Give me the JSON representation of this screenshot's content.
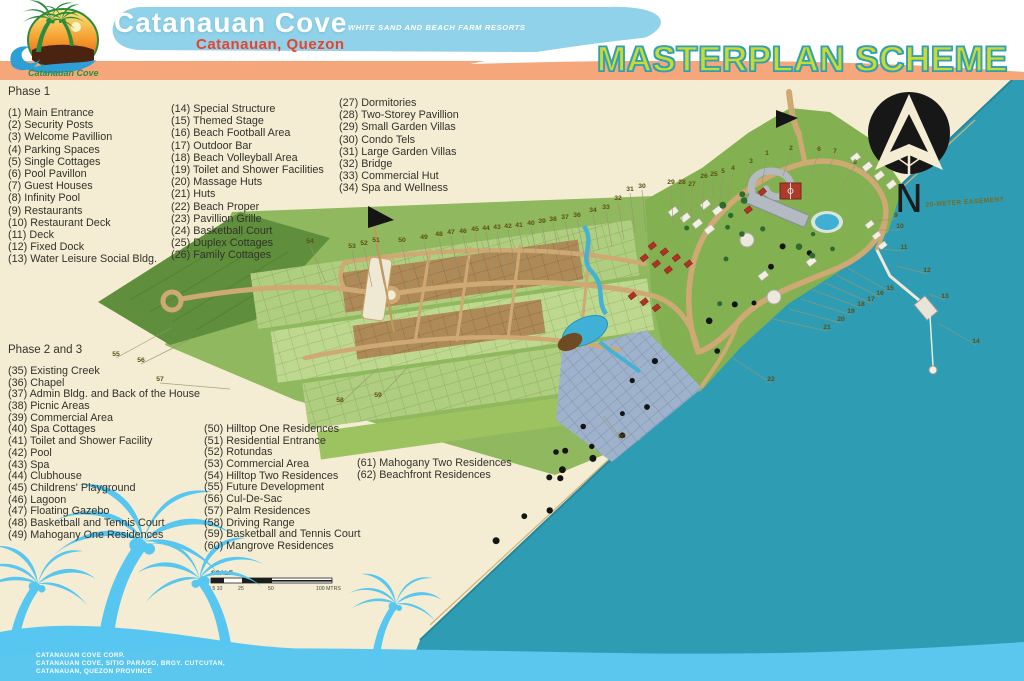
{
  "header": {
    "resort_name": "Catanauan Cove",
    "tagline": "WHITE SAND AND BEACH FARM RESORTS",
    "location": "Catanauan, Quezon",
    "plan_title": "MASTERPLAN SCHEME",
    "logo_script": "Catanauan Cove"
  },
  "legend": {
    "phase1": {
      "title": "Phase 1",
      "columns": [
        [
          "(1) Main Entrance",
          "(2) Security Posts",
          "(3) Welcome Pavillion",
          "(4) Parking Spaces",
          "(5) Single Cottages",
          "(6) Pool Pavillon",
          "(7) Guest Houses",
          "(8) Infinity Pool",
          "(9) Restaurants",
          "(10) Restaurant Deck",
          "(11) Deck",
          "(12) Fixed Dock",
          "(13) Water Leisure Social Bldg."
        ],
        [
          "(14) Special Structure",
          "(15) Themed Stage",
          "(16) Beach Football Area",
          "(17) Outdoor Bar",
          "(18) Beach Volleyball Area",
          "(19) Toilet and Shower Facilities",
          "(20) Massage Huts",
          "(21) Huts",
          "(22) Beach Proper",
          "(23) Pavillion Grille",
          "(24) Basketball Court",
          "(25) Duplex Cottages",
          "(26) Family Cottages"
        ],
        [
          "(27) Dormitories",
          "(28) Two-Storey Pavillion",
          "(29) Small Garden Villas",
          "(30) Condo Tels",
          "(31) Large Garden Villas",
          "(32) Bridge",
          "(33) Commercial Hut",
          "(34) Spa and Wellness"
        ]
      ]
    },
    "phase2": {
      "title": "Phase 2 and 3",
      "columns": [
        [
          "(35) Existing Creek",
          "(36) Chapel",
          "(37) Admin Bldg. and Back of the House",
          "(38) Picnic Areas",
          "(39) Commercial Area",
          "(40) Spa Cottages",
          "(41) Toilet and Shower Facility",
          "(42) Pool",
          "(43) Spa",
          "(44) Clubhouse",
          "(45) Childrens' Playground",
          "(46) Lagoon",
          "(47) Floating Gazebo",
          "(48) Basketball and Tennis Court",
          "(49) Mahogany One Residences"
        ],
        [
          "(50) Hilltop One Residences",
          "(51) Residential Entrance",
          "(52) Rotundas",
          "(53) Commercial Area",
          "(54) Hilltop Two Residences",
          "(55) Future Development",
          "(56) Cul-De-Sac",
          "(57) Palm Residences",
          "(58) Driving Range",
          "(59) Basketball and Tennis Court",
          "(60) Mangrove Residences"
        ],
        [
          "(61) Mahogany Two Residences",
          "(62) Beachfront Residences"
        ]
      ]
    }
  },
  "map": {
    "north_label": "N",
    "easement_label": "20-METER EASEMENT",
    "scale": {
      "label": "SCALE",
      "ticks": [
        "0 5 10",
        "25",
        "50",
        "100 MTRS"
      ]
    },
    "markers": [
      {
        "n": "53",
        "x": 352,
        "y": 248,
        "dx": 8,
        "dy": 42
      },
      {
        "n": "52",
        "x": 364,
        "y": 245,
        "dx": 8,
        "dy": 42
      },
      {
        "n": "51",
        "x": 376,
        "y": 242,
        "dx": 8,
        "dy": 42
      },
      {
        "n": "50",
        "x": 402,
        "y": 242,
        "dx": 8,
        "dy": 42
      },
      {
        "n": "49",
        "x": 424,
        "y": 239,
        "dx": 8,
        "dy": 42
      },
      {
        "n": "48",
        "x": 439,
        "y": 236,
        "dx": 8,
        "dy": 42
      },
      {
        "n": "47",
        "x": 451,
        "y": 234,
        "dx": 8,
        "dy": 42
      },
      {
        "n": "46",
        "x": 463,
        "y": 233,
        "dx": 8,
        "dy": 42
      },
      {
        "n": "45",
        "x": 475,
        "y": 231,
        "dx": 8,
        "dy": 42
      },
      {
        "n": "44",
        "x": 486,
        "y": 230,
        "dx": 8,
        "dy": 42
      },
      {
        "n": "43",
        "x": 497,
        "y": 229,
        "dx": 8,
        "dy": 42
      },
      {
        "n": "42",
        "x": 508,
        "y": 228,
        "dx": 8,
        "dy": 42
      },
      {
        "n": "41",
        "x": 519,
        "y": 227,
        "dx": 8,
        "dy": 42
      },
      {
        "n": "40",
        "x": 531,
        "y": 225,
        "dx": 8,
        "dy": 42
      },
      {
        "n": "39",
        "x": 542,
        "y": 223,
        "dx": 8,
        "dy": 42
      },
      {
        "n": "38",
        "x": 553,
        "y": 221,
        "dx": 8,
        "dy": 42
      },
      {
        "n": "37",
        "x": 565,
        "y": 219,
        "dx": 8,
        "dy": 42
      },
      {
        "n": "36",
        "x": 577,
        "y": 217,
        "dx": 8,
        "dy": 42
      },
      {
        "n": "34",
        "x": 593,
        "y": 212,
        "dx": 6,
        "dy": 38
      },
      {
        "n": "33",
        "x": 606,
        "y": 209,
        "dx": 6,
        "dy": 38
      },
      {
        "n": "32",
        "x": 618,
        "y": 200,
        "dx": 6,
        "dy": 40
      },
      {
        "n": "31",
        "x": 630,
        "y": 191,
        "dx": 5,
        "dy": 42
      },
      {
        "n": "30",
        "x": 642,
        "y": 188,
        "dx": 4,
        "dy": 44
      },
      {
        "n": "29",
        "x": 671,
        "y": 184,
        "dx": 2,
        "dy": 40
      },
      {
        "n": "28",
        "x": 682,
        "y": 184,
        "dx": 0,
        "dy": 38
      },
      {
        "n": "27",
        "x": 692,
        "y": 186,
        "dx": 0,
        "dy": 36
      },
      {
        "n": "26",
        "x": 704,
        "y": 178,
        "dx": -2,
        "dy": 36
      },
      {
        "n": "25",
        "x": 714,
        "y": 176,
        "dx": -3,
        "dy": 34
      },
      {
        "n": "5",
        "x": 723,
        "y": 173,
        "dx": -4,
        "dy": 32
      },
      {
        "n": "4",
        "x": 733,
        "y": 170,
        "dx": -5,
        "dy": 30
      },
      {
        "n": "3",
        "x": 751,
        "y": 163,
        "dx": -6,
        "dy": 28
      },
      {
        "n": "1",
        "x": 767,
        "y": 155,
        "dx": -5,
        "dy": 28
      },
      {
        "n": "2",
        "x": 791,
        "y": 150,
        "dx": -8,
        "dy": 26
      },
      {
        "n": "6",
        "x": 819,
        "y": 151,
        "dx": -10,
        "dy": 26
      },
      {
        "n": "7",
        "x": 835,
        "y": 153,
        "dx": -12,
        "dy": 26
      },
      {
        "n": "8",
        "x": 855,
        "y": 164,
        "dx": -14,
        "dy": 24
      },
      {
        "n": "55",
        "x": 116,
        "y": 356,
        "dx": 55,
        "dy": -28
      },
      {
        "n": "56",
        "x": 141,
        "y": 362,
        "dx": 48,
        "dy": -22
      },
      {
        "n": "57",
        "x": 160,
        "y": 381,
        "dx": 70,
        "dy": 8
      },
      {
        "n": "54",
        "x": 310,
        "y": 243,
        "dx": 16,
        "dy": 40
      },
      {
        "n": "58",
        "x": 340,
        "y": 402,
        "dx": 38,
        "dy": -34
      },
      {
        "n": "59",
        "x": 378,
        "y": 397,
        "dx": 30,
        "dy": -30
      },
      {
        "n": "9",
        "x": 896,
        "y": 217,
        "dx": -22,
        "dy": 4
      },
      {
        "n": "10",
        "x": 900,
        "y": 228,
        "dx": -24,
        "dy": 2
      },
      {
        "n": "11",
        "x": 904,
        "y": 249,
        "dx": -26,
        "dy": 0
      },
      {
        "n": "12",
        "x": 927,
        "y": 272,
        "dx": -30,
        "dy": -6
      },
      {
        "n": "13",
        "x": 945,
        "y": 298,
        "dx": -16,
        "dy": -4
      },
      {
        "n": "14",
        "x": 976,
        "y": 343,
        "dx": -38,
        "dy": -20
      },
      {
        "n": "15",
        "x": 890,
        "y": 290,
        "dx": -42,
        "dy": -22
      },
      {
        "n": "16",
        "x": 880,
        "y": 295,
        "dx": -44,
        "dy": -20
      },
      {
        "n": "17",
        "x": 871,
        "y": 301,
        "dx": -46,
        "dy": -18
      },
      {
        "n": "18",
        "x": 861,
        "y": 306,
        "dx": -48,
        "dy": -16
      },
      {
        "n": "19",
        "x": 851,
        "y": 313,
        "dx": -50,
        "dy": -14
      },
      {
        "n": "20",
        "x": 841,
        "y": 321,
        "dx": -52,
        "dy": -12
      },
      {
        "n": "21",
        "x": 827,
        "y": 329,
        "dx": -54,
        "dy": -10
      },
      {
        "n": "22",
        "x": 771,
        "y": 381,
        "dx": -40,
        "dy": -24
      },
      {
        "n": "60",
        "x": 622,
        "y": 438,
        "dx": -18,
        "dy": -22
      }
    ]
  },
  "footer": {
    "lines": [
      "CATANAUAN COVE CORP.",
      "CATANAUAN COVE, SITIO PARAGO, BRGY. CUTCUTAN,",
      "CATANAUAN, QUEZON PROVINCE"
    ]
  },
  "colors": {
    "ocean": "#2E9DB3",
    "shallow_band": "#5BC6EE",
    "sand": "#F4EDD3",
    "orange_bar": "#F5A77B",
    "banner_blue": "#8FD2E9",
    "location_red": "#E8432B",
    "title_fill": "#C9DA31",
    "title_stroke": "#2FA0B6",
    "palm_blue": "#57C6F0",
    "road_tan": "#CFA973",
    "legend_text": "#32322C",
    "marker_text": "#5E5014"
  }
}
